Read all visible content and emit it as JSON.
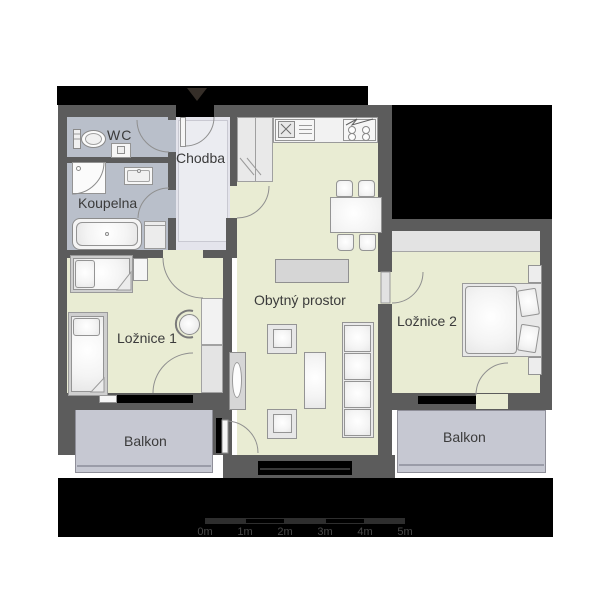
{
  "plan": {
    "title": "apartment-floorplan",
    "rooms": {
      "wc": {
        "label": "WC"
      },
      "koupelna": {
        "label": "Koupelna"
      },
      "chodba": {
        "label": "Chodba"
      },
      "living": {
        "label": "Obytný prostor"
      },
      "bedroom1": {
        "label": "Ložnice 1"
      },
      "bedroom2": {
        "label": "Ložnice 2"
      },
      "balcony_left": {
        "label": "Balkon"
      },
      "balcony_right": {
        "label": "Balkon"
      }
    },
    "scale_bar": {
      "labels": [
        "0m",
        "1m",
        "2m",
        "3m",
        "4m",
        "5m"
      ],
      "segment_meters": 1
    },
    "colors": {
      "wall": "#5c5c5c",
      "floor_main": "#e9ecd3",
      "floor_bath": "#b9bfca",
      "floor_hall": "#e4e4ec",
      "balcony": "#c6c8d2",
      "surround": "#000000",
      "background": "#ffffff",
      "label_text": "#3b3b3b"
    }
  }
}
